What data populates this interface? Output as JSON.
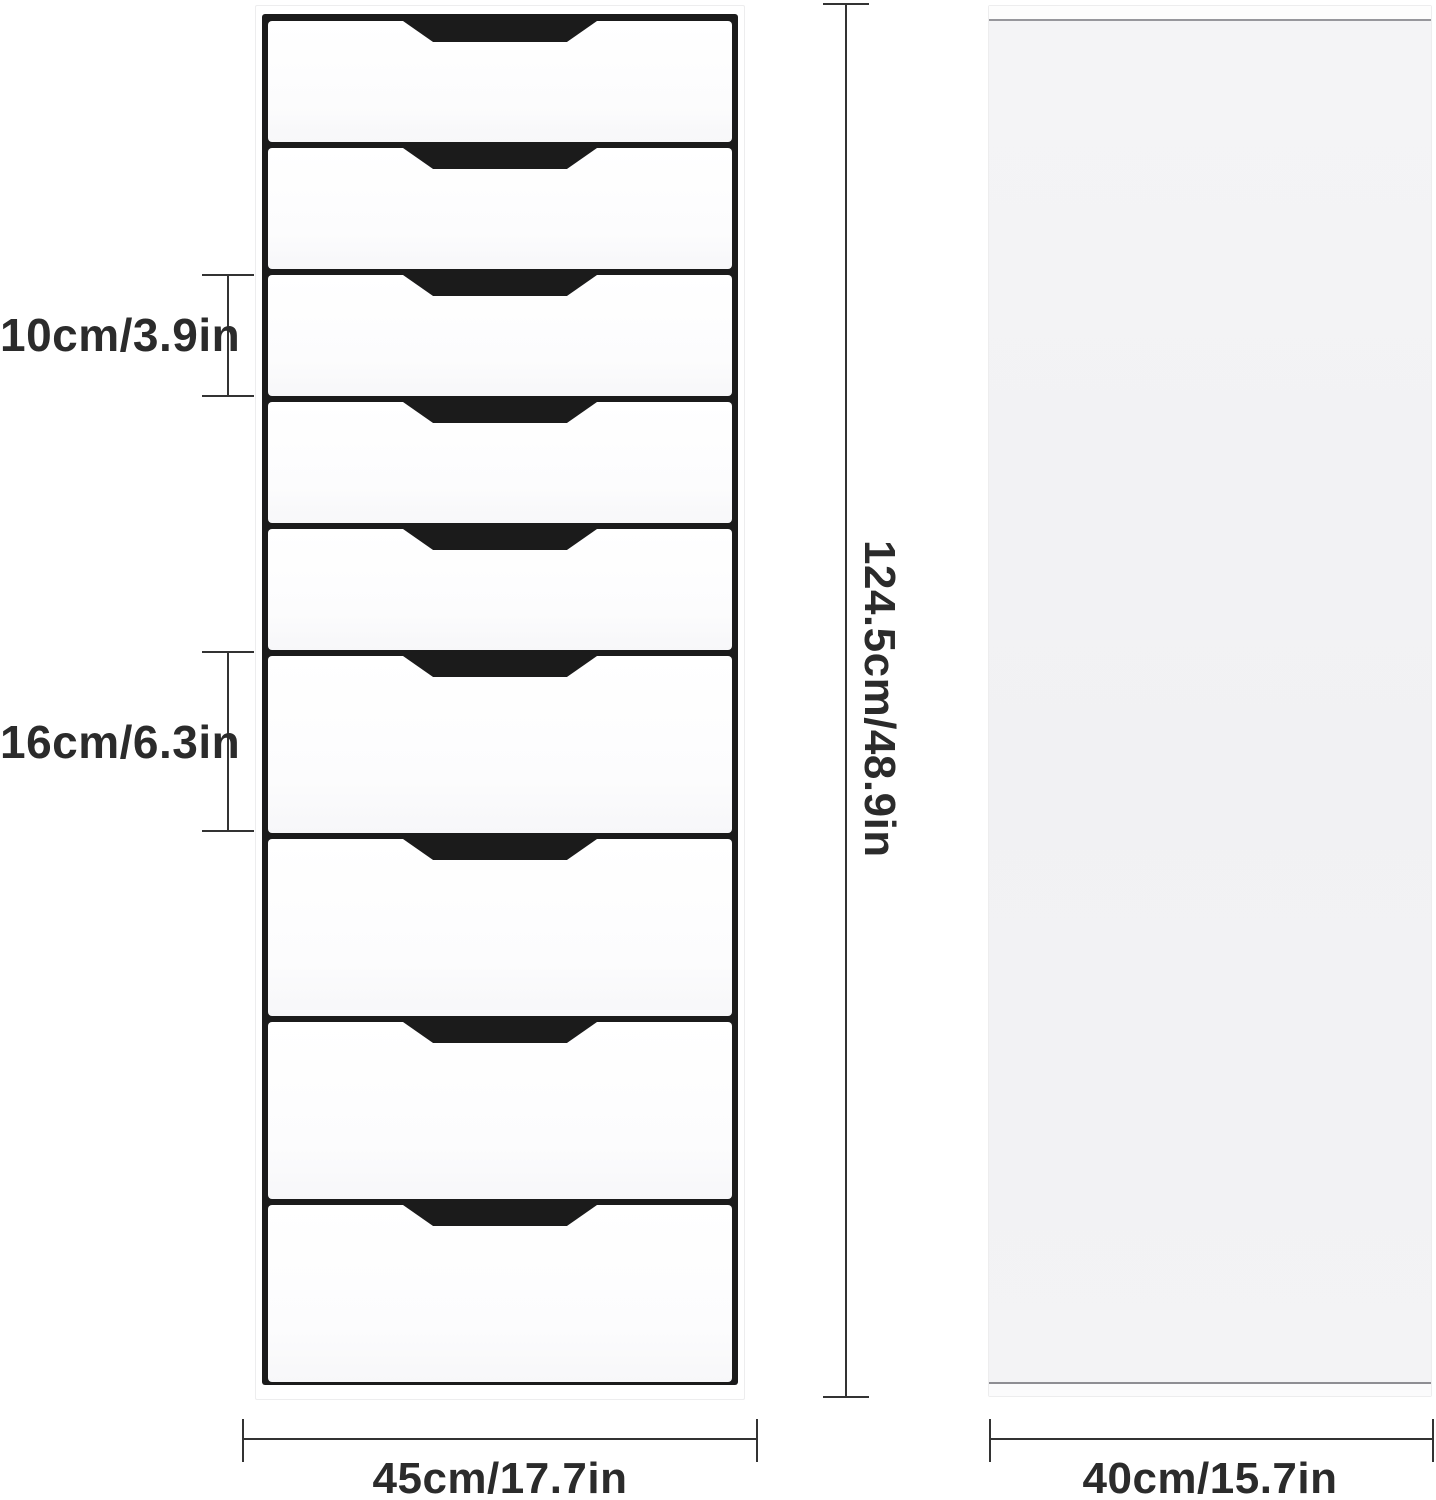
{
  "page": {
    "description": "Product dimension diagram of a tall 9-drawer chest: front view with drawer handle cutouts and plain side panel view",
    "background": "#ffffff"
  },
  "front_view": {
    "name": "front view of 9-drawer chest",
    "drawers": [
      {
        "size": "small"
      },
      {
        "size": "small"
      },
      {
        "size": "small"
      },
      {
        "size": "small"
      },
      {
        "size": "small"
      },
      {
        "size": "large"
      },
      {
        "size": "large"
      },
      {
        "size": "large"
      },
      {
        "size": "large"
      }
    ]
  },
  "side_view": {
    "name": "side view panel"
  },
  "dimensions": {
    "small_drawer_height": "10cm/3.9in",
    "large_drawer_height": "16cm/6.3in",
    "total_height": "124.5cm/48.9in",
    "width": "45cm/17.7in",
    "depth": "40cm/15.7in"
  },
  "colors": {
    "text": "#2b2b2b",
    "dimension_line": "#333333",
    "cabinet_interior": "#1b1b1b",
    "drawer_front": "#fdfdfe",
    "side_panel_body": "#f2f2f4"
  }
}
